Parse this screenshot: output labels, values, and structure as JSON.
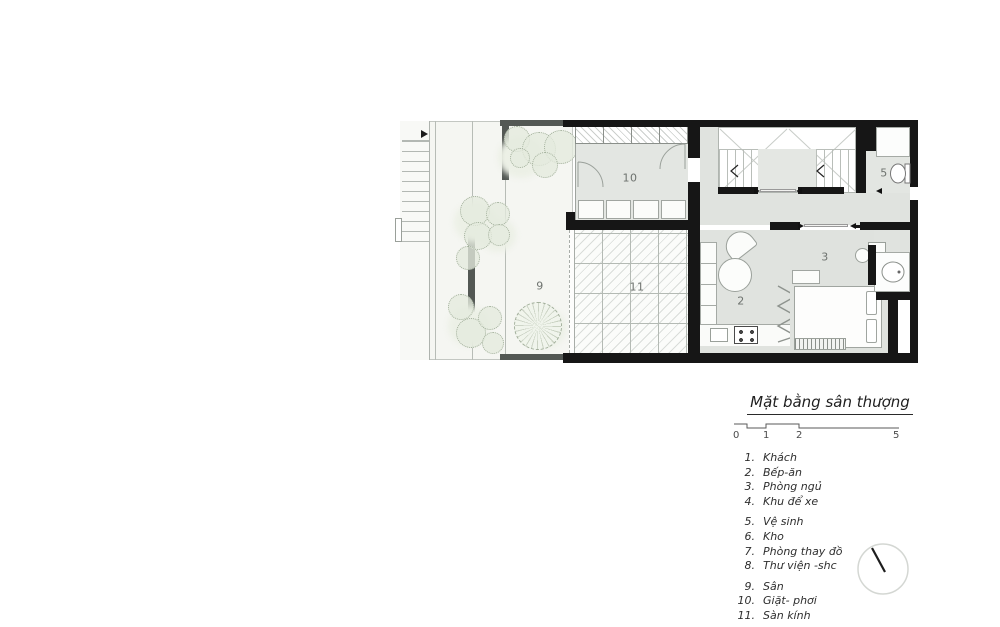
{
  "plan": {
    "title": "Mặt bằng sân thượng",
    "rooms": {
      "kitchen_dining": "2",
      "bedroom": "3",
      "wc": "5",
      "yard": "9",
      "laundry": "10",
      "glass_floor": "11"
    }
  },
  "scale_bar": {
    "ticks": [
      "0",
      "1",
      "2",
      "5"
    ]
  },
  "legend": {
    "items": [
      {
        "num": "1.",
        "text": "Khách"
      },
      {
        "num": "2.",
        "text": "Bếp-ăn"
      },
      {
        "num": "3.",
        "text": "Phòng ngủ"
      },
      {
        "num": "4.",
        "text": "Khu để xe"
      },
      {
        "num": "5.",
        "text": "Vệ sinh"
      },
      {
        "num": "6.",
        "text": "Kho"
      },
      {
        "num": "7.",
        "text": "Phòng thay đồ"
      },
      {
        "num": "8.",
        "text": "Thư viện -shc"
      },
      {
        "num": "9.",
        "text": "Sân"
      },
      {
        "num": "10.",
        "text": "Giặt- phơi"
      },
      {
        "num": "11.",
        "text": "Sàn kính"
      }
    ]
  },
  "colors": {
    "wall": "#161616",
    "wall_gray": "#535854",
    "room_fill": "#e3e6e2",
    "room_fill_dark": "#dfe2de",
    "yard_fill": "#f5f6f2",
    "glass_fill": "#fbfcfa",
    "tree_fill": "#e4ebde",
    "tree_outline": "#a2af9b",
    "label": "#6d726e",
    "ink": "#2e2e2e"
  }
}
